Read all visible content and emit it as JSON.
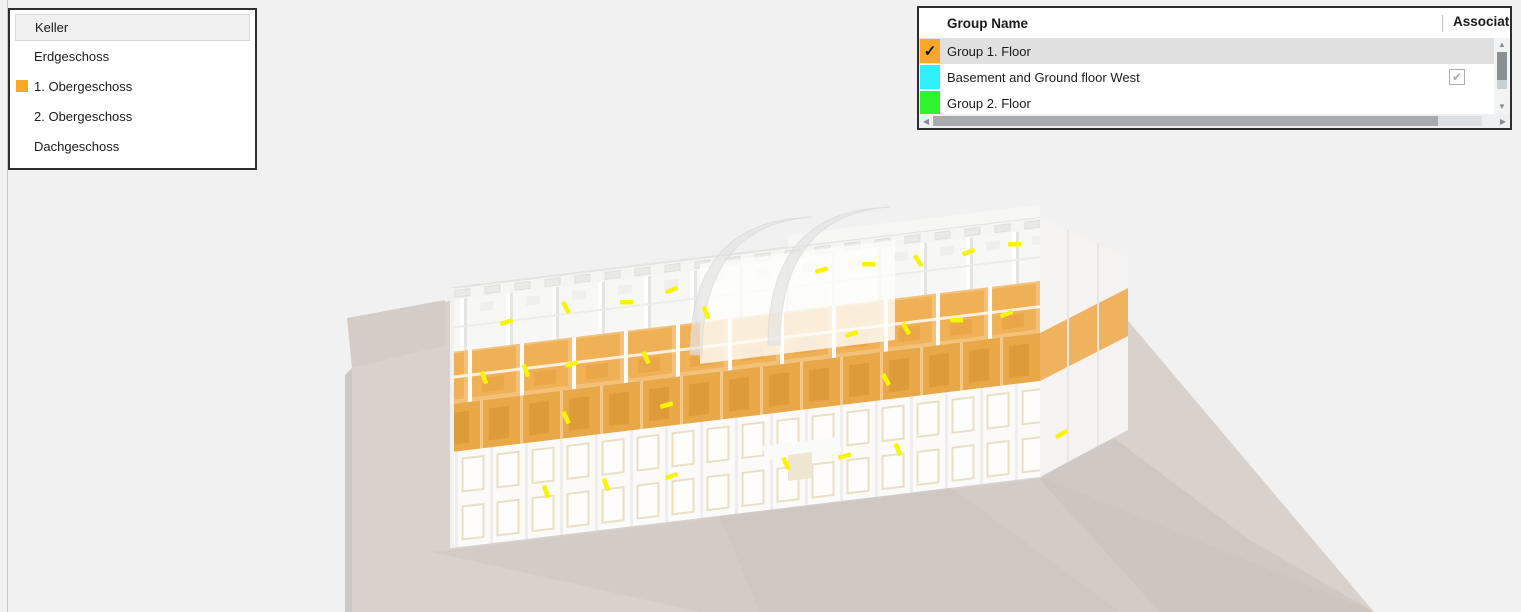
{
  "window": {
    "background_color": "#F1F1F1",
    "left_border_color": "#C6C6C6"
  },
  "floor_panel": {
    "items": [
      {
        "label": "Keller",
        "highlighted": true
      },
      {
        "label": "Erdgeschoss"
      },
      {
        "label": "1. Obergeschoss",
        "marker_color": "#F9A72B"
      },
      {
        "label": "2. Obergeschoss"
      },
      {
        "label": "Dachgeschoss"
      }
    ]
  },
  "group_panel": {
    "columns": {
      "name": "Group Name",
      "association": "Association"
    },
    "rows": [
      {
        "name": "Group 1. Floor",
        "color": "#F9A72B",
        "swatch_checked": true,
        "selected": true
      },
      {
        "name": "Basement and Ground floor West",
        "color": "#30EFFA",
        "association_checked": true
      },
      {
        "name": "Group 2. Floor",
        "color": "#2FF32F"
      }
    ]
  },
  "icons": {
    "swatch_check": "✓",
    "checkbox_check": "✔",
    "scroll_up": "▲",
    "scroll_down": "▼",
    "scroll_left": "◀",
    "scroll_right": "▶"
  },
  "scene": {
    "ground_color": "#D8D1CC",
    "ground_shadow_color": "#CBC2BC",
    "building_color": "#FBFAF9",
    "highlighted_floor_color": "#F0AE55",
    "highlighted_floor_front_color": "#E9A848",
    "light_fixture_color": "#F8F407",
    "highlighted_floor_name": "1. Obergeschoss",
    "highlighted_group_name": "Group 1. Floor"
  }
}
